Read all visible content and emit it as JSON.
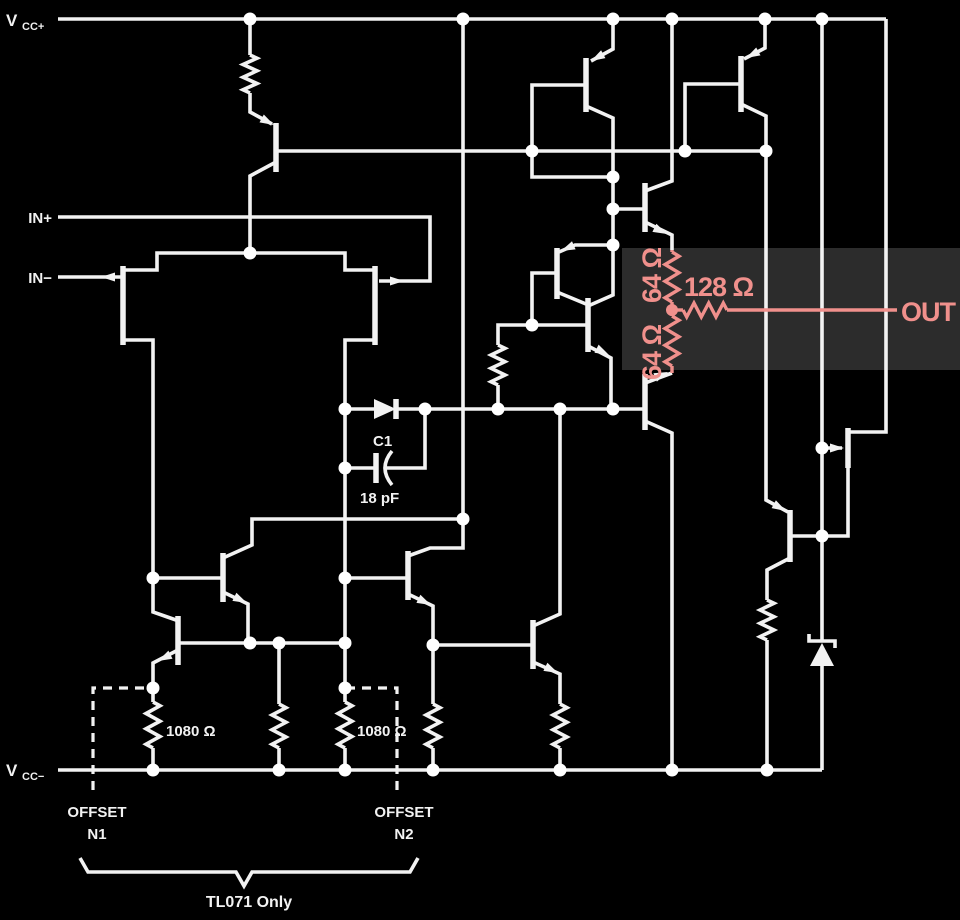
{
  "schematic": {
    "power": {
      "vcc_plus": {
        "main": "V",
        "sub": "CC+"
      },
      "vcc_minus": {
        "main": "V",
        "sub": "CC−"
      }
    },
    "inputs": {
      "non_inverting": "IN+",
      "inverting": "IN−"
    },
    "output_label": "OUT",
    "compensation_capacitor": {
      "designator": "C1",
      "value": "18 pF"
    },
    "highlighted_output_network": {
      "r_top": "64 Ω",
      "r_bottom": "64 Ω",
      "r_series": "128 Ω"
    },
    "offset_network": {
      "r_left": "1080 Ω",
      "r_right": "1080 Ω",
      "pin_left": {
        "line1": "OFFSET",
        "line2": "N1"
      },
      "pin_right": {
        "line1": "OFFSET",
        "line2": "N2"
      },
      "note": "TL071 Only"
    },
    "colors": {
      "background": "#000000",
      "wire": "#f2f2f2",
      "highlight_box": "#2c2c2c",
      "accent": "#f0908c"
    }
  }
}
